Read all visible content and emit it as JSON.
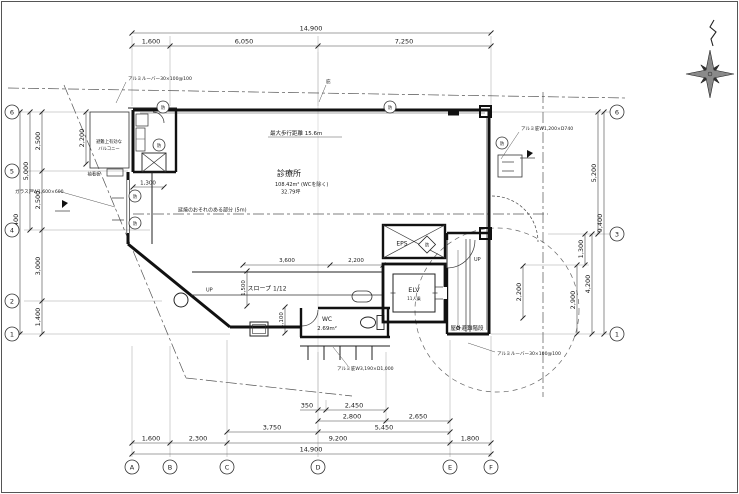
{
  "plan": {
    "rooms": {
      "clinic": {
        "label": "診療所",
        "area": "108.42m² (WCを除く)",
        "tsubo": "32.79坪"
      },
      "wc": {
        "label": "WC",
        "area": "2.69m²"
      },
      "elevator": {
        "label": "ELV",
        "capacity": "11人乗"
      },
      "eps": {
        "label": "EPS"
      },
      "stairs": {
        "label": "屋外避難階段"
      },
      "balcony_line1": "避難上有効な",
      "balcony_line2": "バルコニー",
      "ramp": {
        "label": "スロープ 1/12"
      }
    },
    "annotations": {
      "louver_top": "アルミルーバー30×100@100",
      "louver_bottom": "アルミルーバー30×100@100",
      "max_walking": "最大歩行距離 15.6m",
      "fire_spread": "延焼のおそれのある部分 (5m)",
      "glass_door": "ガラス戸W1,600×600",
      "canopy_east": "アルミ庇W1,200×D740",
      "canopy_south": "アルミ庇W3,190×D1,000",
      "sleeve_sign": "袖看板",
      "eaves": "庇",
      "up_ramp": "UP",
      "up_stairs": "UP",
      "fire_mark": "防"
    },
    "dims": {
      "top": {
        "total": "14,900",
        "s1": "1,600",
        "s2": "6,050",
        "s3": "7,250"
      },
      "bottom": {
        "total": "14,900",
        "r1": [
          "350",
          "2,450"
        ],
        "r2": [
          "2,800",
          "2,650"
        ],
        "r3": [
          "3,750",
          "5,450"
        ],
        "r4": [
          "1,600",
          "2,300",
          "9,200",
          "1,800"
        ]
      },
      "left": {
        "total": "9,400",
        "sub": "5,000",
        "s": [
          "2,500",
          "2,500",
          "3,000",
          "1,400"
        ],
        "balcony": "2,200"
      },
      "right": {
        "total": "9,400",
        "upper": "5,200",
        "lower": "4,200",
        "s1": "1,300",
        "s2": "2,900",
        "stair": "2,200"
      },
      "inner": {
        "room": "1,300",
        "ramp1": "3,600",
        "ramp2": "2,200",
        "ramp_w": "1,500",
        "porch": "1,100"
      }
    },
    "grid": {
      "bottom": [
        "A",
        "B",
        "C",
        "D",
        "E",
        "F"
      ],
      "left": [
        "6",
        "5",
        "4",
        "2",
        "1"
      ],
      "right": [
        "6",
        "3",
        "1"
      ]
    }
  }
}
